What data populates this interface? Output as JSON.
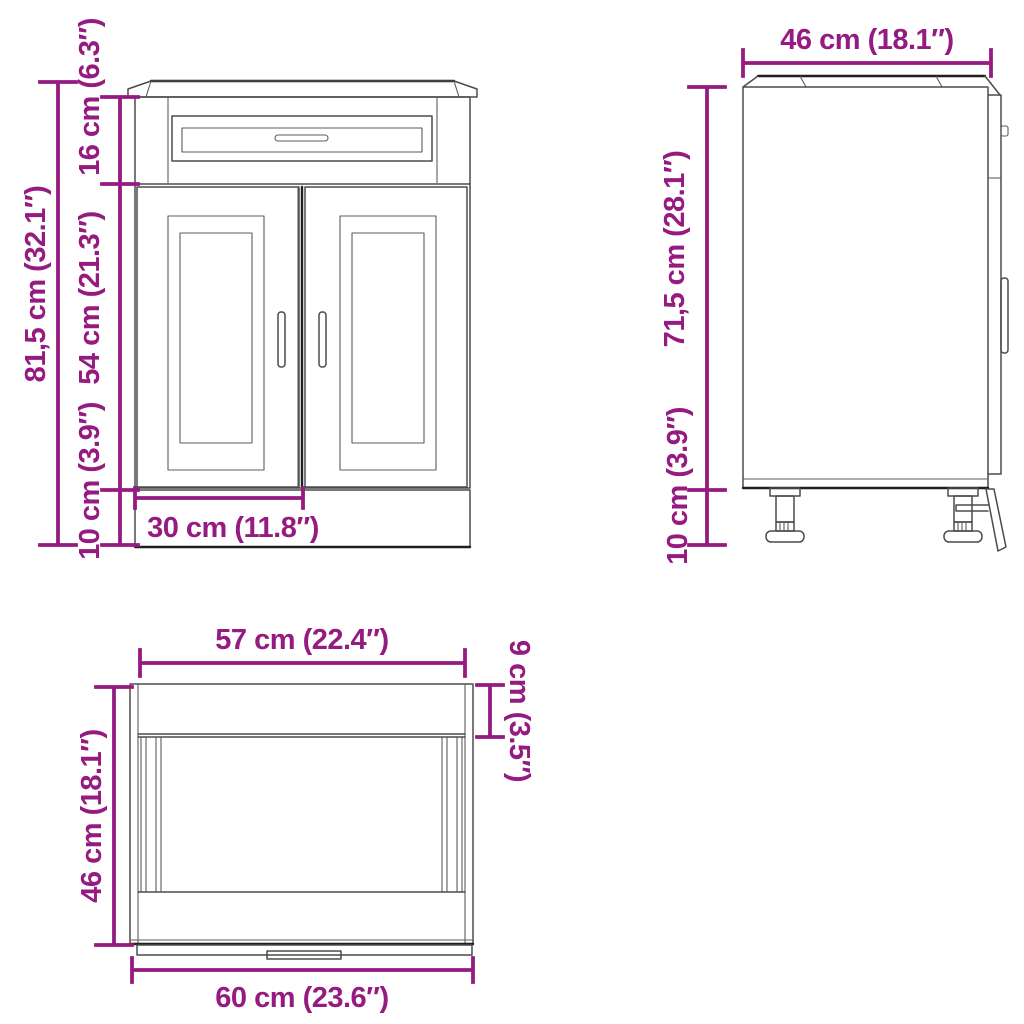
{
  "colors": {
    "dimension": "#951B81",
    "line_thin": "#4b4b4b",
    "line_bold": "#1f1f1f",
    "background": "#ffffff"
  },
  "views": {
    "front": {
      "dims": {
        "total_height": "81,5 cm (32.1″)",
        "top_section_height": "16 cm (6.3″)",
        "door_height": "54 cm (21.3″)",
        "plinth_height": "10 cm (3.9″)",
        "door_width": "30 cm (11.8″)"
      }
    },
    "side": {
      "dims": {
        "depth": "46 cm (18.1″)",
        "body_height": "71,5 cm (28.1″)",
        "leg_height": "10 cm (3.9″)"
      }
    },
    "top": {
      "dims": {
        "inner_width": "57 cm (22.4″)",
        "top_band_depth": "9 cm (3.5″)",
        "depth": "46 cm (18.1″)",
        "total_width": "60 cm (23.6″)"
      }
    }
  }
}
